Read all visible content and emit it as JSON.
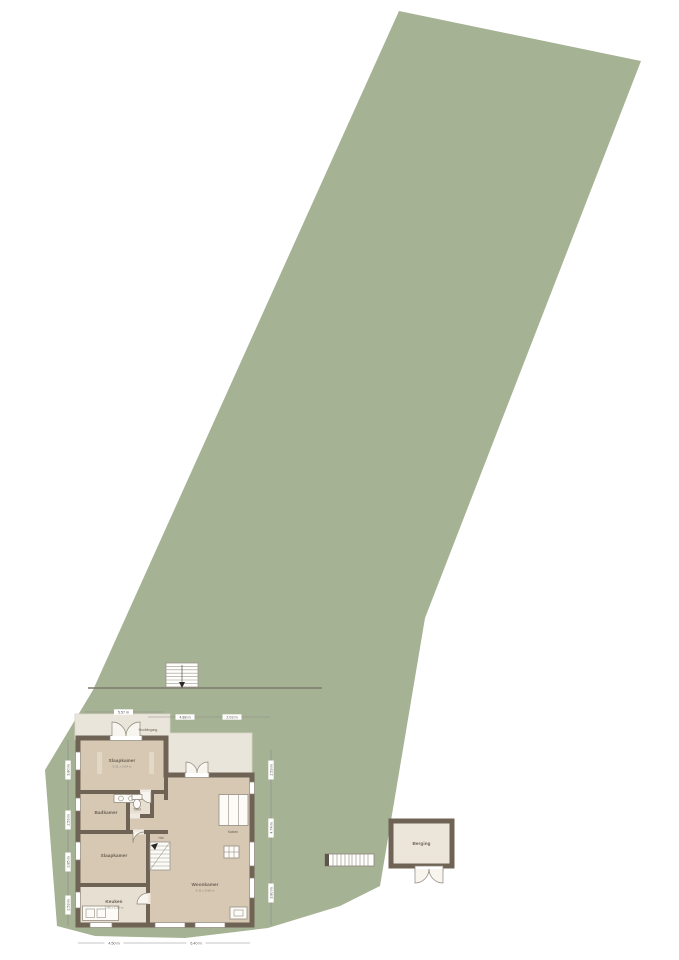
{
  "title": "Plot situation floor plan",
  "colors": {
    "background": "#ffffff",
    "plot_green": "#a6b294",
    "terrace": "#eae5da",
    "room_floor": "#d7c8b4",
    "room_floor_light": "#e7dfd1",
    "wall": "#6f6355",
    "outbuilding_floor": "#ece6da",
    "dimension_line": "#8c8c8c"
  },
  "entrance": {
    "label": "Hoofdingang"
  },
  "rooms": {
    "slaapkamer_1": {
      "name": "Slaapkamer",
      "size": "5.31 x 3.04 m"
    },
    "badkamer": {
      "name": "Badkamer"
    },
    "toilet": {
      "name": "Toilet"
    },
    "hal": {
      "name": "Hal"
    },
    "kasten": {
      "name": "Kasten"
    },
    "slaapkamer_2": {
      "name": "Slaapkamer"
    },
    "keuken": {
      "name": "Keuken",
      "size": "3.92 x 2.28 m"
    },
    "woonkamer": {
      "name": "Woonkamer",
      "size": "6.31 x 5.68 m"
    }
  },
  "outbuilding": {
    "name": "Berging"
  },
  "dimensions": {
    "top": [
      "5.57 m",
      "4.88 m",
      "2.03 m"
    ],
    "bottom": [
      "4.50 m",
      "6.40 m"
    ],
    "left": [
      "3.80 m",
      "2.53 m",
      "2.85 m",
      "2.53 m"
    ],
    "right": [
      "2.53 m",
      "4.74 m",
      "3.80 m"
    ]
  }
}
